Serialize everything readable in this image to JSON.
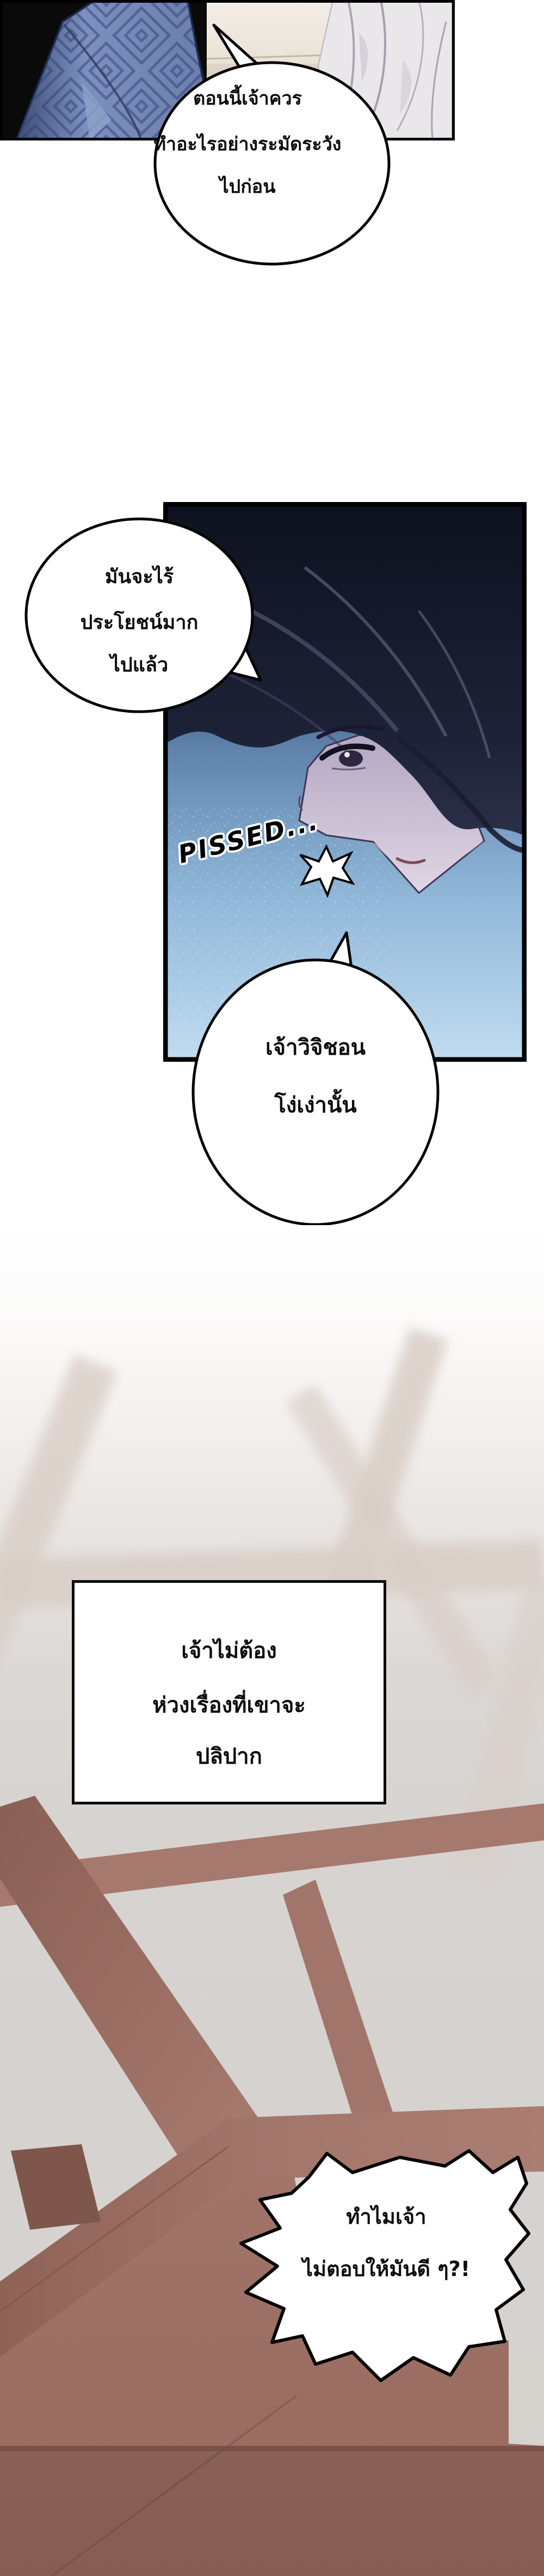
{
  "page": {
    "kind": "webtoon-comic-strip",
    "language": "th"
  },
  "panel1": {
    "bubble": {
      "lines": [
        "ตอนนี้เจ้าควร",
        "ทำอะไรอย่างระมัดระวัง",
        "ไปก่อน"
      ]
    }
  },
  "panel2": {
    "bubble_left": {
      "lines": [
        "มันจะไร้",
        "ประโยชน์มาก",
        "ไปแล้ว"
      ]
    },
    "sfx": "PISSED...",
    "bubble_bottom": {
      "lines": [
        "เจ้าวิจิชอน",
        "โง่เง่านั้น"
      ]
    }
  },
  "panel3": {
    "caption": {
      "lines": [
        "เจ้าไม่ต้อง",
        "ห่วงเรื่องที่เขาจะ",
        "ปลิปาก"
      ]
    },
    "shout_bubble": {
      "lines": [
        "ทำไมเจ้า",
        "ไม่ตอบให้มันดี ๆ?!"
      ]
    }
  },
  "colors": {
    "panel_border": "#000000",
    "bubble_fill": "#ffffff",
    "garment_blue": "#7d90bd",
    "garment_white": "#e9e7ea",
    "panel2_sky_top": "#1b2940",
    "panel2_sky_bottom": "#c0dcf0",
    "hair_dark": "#0d1220",
    "skin_lavender": "#ddd3e0",
    "wood_beam": "#a3766c",
    "haze_gray": "#d5d1ce"
  }
}
